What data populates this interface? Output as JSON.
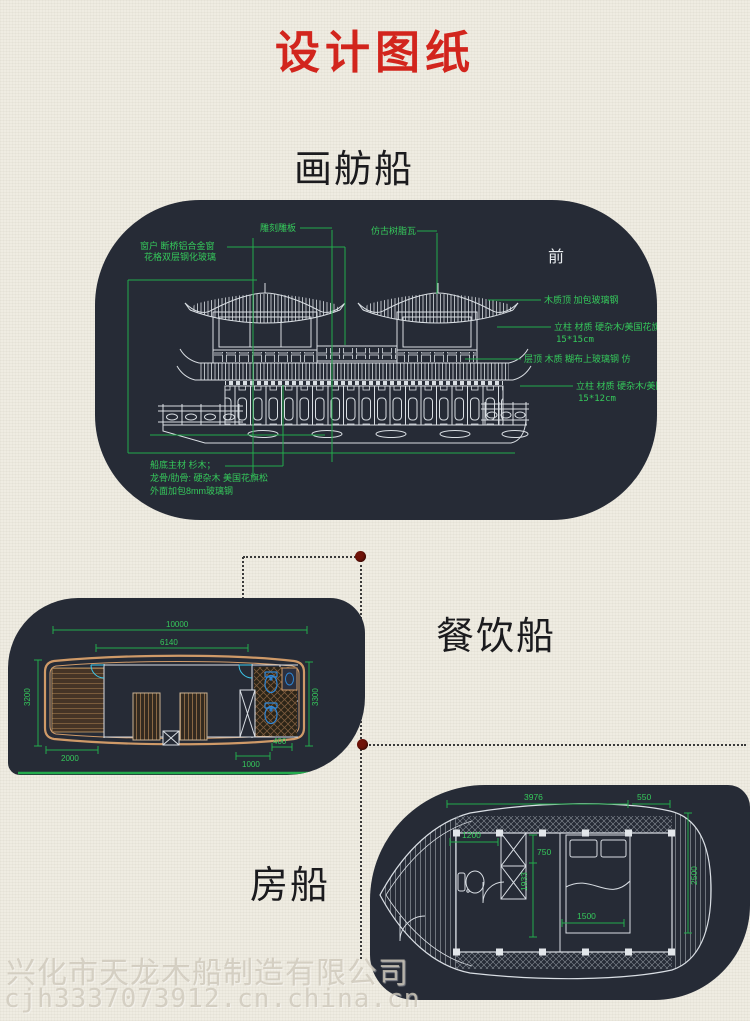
{
  "page": {
    "title": "设计图纸"
  },
  "labels": {
    "boat1": "画舫船",
    "boat2": "餐饮船",
    "boat3": "房船"
  },
  "d1": {
    "front": "前",
    "win1": "窗户 断桥铝合金窗",
    "win2": "花格双层钢化玻璃",
    "carve": "雕刻雕板",
    "tile": "仿古树脂瓦",
    "roof_top": "木质顶 加包玻璃钢",
    "col1": "立柱 材质 硬杂木/美国花旗松",
    "col1s": "15*15cm",
    "deck_roof": "层顶 木质 糊布上玻璃钢 仿",
    "col2": "立柱 材质 硬杂木/美国",
    "col2s": "15*12cm",
    "hull1": "船底主材 杉木；",
    "hull2": "龙骨/肋骨: 硬杂木 美国花旗松",
    "hull3": "外面加包8mm玻璃钢"
  },
  "d2": {
    "len": "10000",
    "cabin": "6140",
    "wl": "3200",
    "wr": "3300",
    "bow": "2000",
    "aft": "1000",
    "aft2": "400"
  },
  "d3": {
    "top": "3976",
    "tr": "550",
    "tl": "50",
    "right": "2500",
    "a": "1200",
    "b": "750",
    "c": "1933",
    "bed": "1500"
  },
  "watermark": {
    "line1": "兴化市天龙木船制造有限公司",
    "line2": "cjh3337073912.cn.china.cn"
  },
  "colors": {
    "accent_red": "#d2251d",
    "cad_green": "#23ab4c",
    "panel_bg": "#262b36",
    "hull_tan": "#cf9a68",
    "fixture_blue": "#2f86d6",
    "door_cyan": "#3cc9ee",
    "dot_red": "#701309",
    "paper": "#efece2",
    "ink": "#1b1b1e"
  }
}
